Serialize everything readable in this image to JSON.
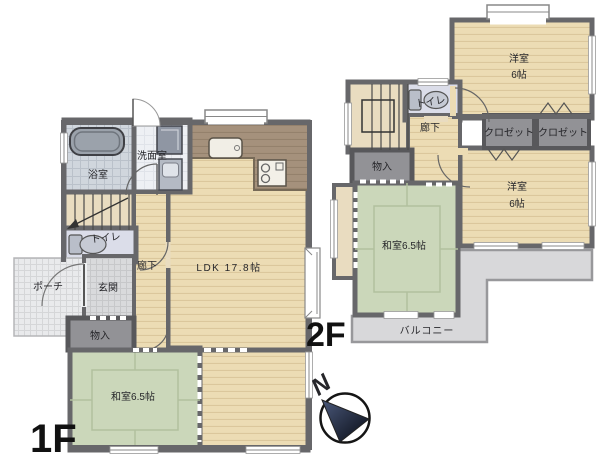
{
  "title": "2-story house floor plan",
  "floor1": {
    "floor_label": "1F",
    "rooms": {
      "ldk": "LDK 17.8帖",
      "japanese_room": "和室6.5帖",
      "bath": "浴室",
      "washroom": "洗面室",
      "toilet": "トイレ",
      "hallway": "廊下",
      "entrance": "玄関",
      "porch": "ポーチ",
      "storage": "物入"
    }
  },
  "floor2": {
    "floor_label": "2F",
    "rooms": {
      "western_room_top": "洋室",
      "western_room_top_size": "6帖",
      "western_room_bottom": "洋室",
      "western_room_bottom_size": "6帖",
      "japanese_room": "和室6.5帖",
      "closet_left": "クロゼット",
      "closet_right": "クロゼット",
      "toilet": "トイレ",
      "hallway": "廊下",
      "storage": "物入",
      "balcony": "バルコニー"
    }
  },
  "compass": {
    "north": "N"
  },
  "colors": {
    "wall": "#67676a",
    "wood_floor": "#ecdcb4",
    "kitchen_floor": "#a5917c",
    "tatami": "#cbd7ba",
    "closet_gray": "#929296",
    "balcony": "#d8d8da",
    "bath_floor": "#d0d6dd",
    "toilet_floor": "#dbdde9",
    "text": "#26262a"
  }
}
